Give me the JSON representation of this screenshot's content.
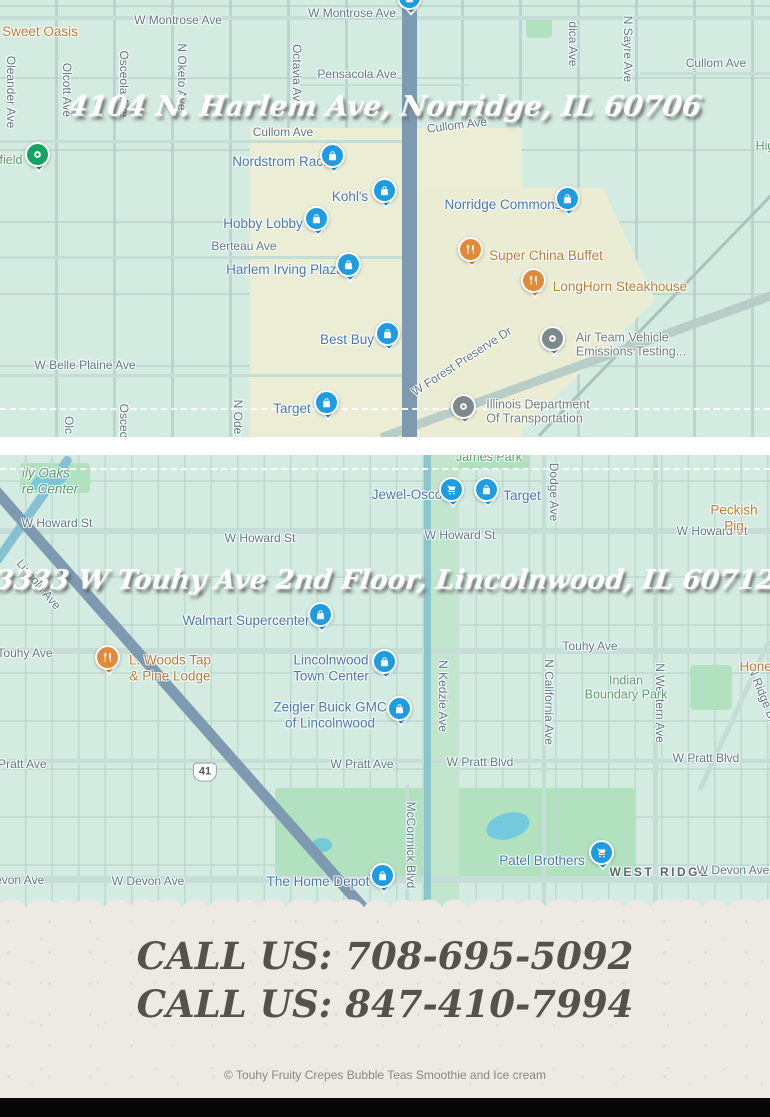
{
  "colors": {
    "pin_blue": "#1d9ce2",
    "pin_orange": "#e18a3a",
    "pin_green": "#15a364",
    "pin_gray": "#7c8a8c",
    "paper": "#eceae3",
    "ink": "#56514b"
  },
  "icons": {
    "shopping": "shopping-bag-pin-icon",
    "grocery": "shopping-cart-pin-icon",
    "restaurant": "restaurant-pin-icon",
    "park": "park-pin-icon",
    "civic": "civic-pin-icon"
  },
  "map1": {
    "title": "4104 N. Harlem Ave, Norridge, IL 60706",
    "labels": [
      {
        "text": "W Montrose Ave",
        "x": 178,
        "y": 21,
        "type": "street"
      },
      {
        "text": "W Montrose Ave",
        "x": 352,
        "y": 14,
        "type": "street"
      },
      {
        "text": "Pensacola Ave",
        "x": 357,
        "y": 75,
        "type": "street"
      },
      {
        "text": "Cullom Ave",
        "x": 283,
        "y": 133,
        "type": "street"
      },
      {
        "text": "Cullom Ave",
        "x": 457,
        "y": 126,
        "type": "street",
        "rot": -7
      },
      {
        "text": "Cullom Ave",
        "x": 716,
        "y": 64,
        "type": "street"
      },
      {
        "text": "Berteau Ave",
        "x": 244,
        "y": 247,
        "type": "street"
      },
      {
        "text": "W Belle Plaine Ave",
        "x": 85,
        "y": 366,
        "type": "street"
      },
      {
        "text": "W Forest Preserve Dr",
        "x": 462,
        "y": 362,
        "type": "street",
        "rot": -33
      },
      {
        "text": "Oleander Ave",
        "x": 10,
        "y": 92,
        "type": "street",
        "vert": true
      },
      {
        "text": "Olcott Ave",
        "x": 66,
        "y": 90,
        "type": "street",
        "vert": true
      },
      {
        "text": "Osceola Ave",
        "x": 123,
        "y": 84,
        "type": "street",
        "vert": true
      },
      {
        "text": "N Oketo Ave",
        "x": 181,
        "y": 77,
        "type": "street",
        "vert": true
      },
      {
        "text": "Octavia Ave",
        "x": 296,
        "y": 76,
        "type": "street",
        "vert": true
      },
      {
        "text": "dica Ave",
        "x": 572,
        "y": 44,
        "type": "street",
        "vert": true
      },
      {
        "text": "N Sayre Ave",
        "x": 627,
        "y": 49,
        "type": "street",
        "vert": true
      },
      {
        "text": "Olc",
        "x": 68,
        "y": 425,
        "type": "street",
        "vert": true
      },
      {
        "text": "Osceo",
        "x": 123,
        "y": 421,
        "type": "street",
        "vert": true
      },
      {
        "text": "N Ode",
        "x": 237,
        "y": 417,
        "type": "street",
        "vert": true
      },
      {
        "text": "Sweet Oasis",
        "x": 40,
        "y": 32,
        "type": "poi-orange"
      },
      {
        "text": "field",
        "x": 11,
        "y": 160,
        "type": "poi-green"
      },
      {
        "text": "Hig",
        "x": 765,
        "y": 146,
        "type": "poi-green"
      },
      {
        "text": "Nordstrom Rack",
        "x": 281,
        "y": 162,
        "type": "poi-blue"
      },
      {
        "text": "Kohl's",
        "x": 350,
        "y": 197,
        "type": "poi-blue"
      },
      {
        "text": "Hobby Lobby",
        "x": 263,
        "y": 224,
        "type": "poi-blue"
      },
      {
        "text": "Harlem Irving Plaza",
        "x": 285,
        "y": 270,
        "type": "poi-blue"
      },
      {
        "text": "Norridge Commons",
        "x": 503,
        "y": 205,
        "type": "poi-blue"
      },
      {
        "text": "Super China Buffet",
        "x": 546,
        "y": 256,
        "type": "poi-orange"
      },
      {
        "text": "LongHorn Steakhouse",
        "x": 620,
        "y": 287,
        "type": "poi-orange"
      },
      {
        "text": "Best Buy",
        "x": 347,
        "y": 340,
        "type": "poi-blue"
      },
      {
        "text": "Target",
        "x": 292,
        "y": 409,
        "type": "poi-blue"
      },
      {
        "text": "Air Team Vehicle\nEmissions Testing...",
        "x": 631,
        "y": 345,
        "type": "poi-gray"
      },
      {
        "text": "Illinois Department\nOf Transportation",
        "x": 538,
        "y": 412,
        "type": "poi-gray"
      }
    ],
    "markers": [
      {
        "kind": "shopping",
        "x": 410,
        "y": 3
      },
      {
        "kind": "shopping",
        "x": 333,
        "y": 161
      },
      {
        "kind": "shopping",
        "x": 385,
        "y": 196
      },
      {
        "kind": "shopping",
        "x": 317,
        "y": 224
      },
      {
        "kind": "shopping",
        "x": 349,
        "y": 270
      },
      {
        "kind": "shopping",
        "x": 568,
        "y": 204
      },
      {
        "kind": "restaurant",
        "x": 471,
        "y": 255
      },
      {
        "kind": "restaurant",
        "x": 534,
        "y": 286
      },
      {
        "kind": "shopping",
        "x": 388,
        "y": 339
      },
      {
        "kind": "shopping",
        "x": 327,
        "y": 408
      },
      {
        "kind": "civic",
        "x": 553,
        "y": 344
      },
      {
        "kind": "civic",
        "x": 464,
        "y": 412
      },
      {
        "kind": "park",
        "x": 38,
        "y": 160
      }
    ]
  },
  "map2": {
    "title": "3333 W Touhy Ave 2nd Floor, Lincolnwood, IL 60712",
    "labels": [
      {
        "text": "James Park",
        "x": 489,
        "y": 2,
        "type": "poi-green"
      },
      {
        "text": "ily Oaks\nre Center",
        "x": 50,
        "y": 26,
        "type": "poi-green-italic"
      },
      {
        "text": "W Howard St",
        "x": 57,
        "y": 69,
        "type": "street"
      },
      {
        "text": "W Howard St",
        "x": 260,
        "y": 84,
        "type": "street"
      },
      {
        "text": "W Howard St",
        "x": 460,
        "y": 81,
        "type": "street"
      },
      {
        "text": "W Howard St",
        "x": 712,
        "y": 77,
        "type": "street"
      },
      {
        "text": "Peckish Pig",
        "x": 734,
        "y": 63,
        "type": "poi-orange"
      },
      {
        "text": "Lincoln Ave",
        "x": 38,
        "y": 130,
        "type": "street",
        "rot": 50
      },
      {
        "text": "Dodge Ave",
        "x": 553,
        "y": 37,
        "type": "street",
        "vert": true
      },
      {
        "text": "Touhy Ave",
        "x": 25,
        "y": 199,
        "type": "street"
      },
      {
        "text": "Touhy Ave",
        "x": 590,
        "y": 192,
        "type": "street"
      },
      {
        "text": "N Kedzie Ave",
        "x": 442,
        "y": 241,
        "type": "street",
        "vert": true
      },
      {
        "text": "N California Ave",
        "x": 548,
        "y": 247,
        "type": "street",
        "vert": true
      },
      {
        "text": "N Western Ave",
        "x": 659,
        "y": 248,
        "type": "street",
        "vert": true
      },
      {
        "text": "N Ridge Blvd",
        "x": 764,
        "y": 245,
        "type": "street",
        "rot": 68
      },
      {
        "text": "Indian\nBoundary Park",
        "x": 626,
        "y": 233,
        "type": "poi-green"
      },
      {
        "text": "Honey",
        "x": 759,
        "y": 212,
        "type": "poi-orange"
      },
      {
        "text": "W Pratt Ave",
        "x": 15,
        "y": 310,
        "type": "street"
      },
      {
        "text": "W Pratt Ave",
        "x": 362,
        "y": 310,
        "type": "street"
      },
      {
        "text": "41",
        "x": 205,
        "y": 317,
        "type": "shield"
      },
      {
        "text": "W Pratt Blvd",
        "x": 480,
        "y": 308,
        "type": "street"
      },
      {
        "text": "W Pratt Blvd",
        "x": 706,
        "y": 304,
        "type": "street"
      },
      {
        "text": "McCormick Blvd",
        "x": 410,
        "y": 390,
        "type": "street",
        "vert": true
      },
      {
        "text": "W Devon Ave",
        "x": 8,
        "y": 426,
        "type": "street"
      },
      {
        "text": "W Devon Ave",
        "x": 148,
        "y": 427,
        "type": "street"
      },
      {
        "text": "WEST RIDGE",
        "x": 660,
        "y": 418,
        "type": "poi-dark"
      },
      {
        "text": "W Devon Ave",
        "x": 733,
        "y": 416,
        "type": "street"
      },
      {
        "text": "Jewel-Osco",
        "x": 407,
        "y": 40,
        "type": "poi-blue"
      },
      {
        "text": "Target",
        "x": 522,
        "y": 41,
        "type": "poi-blue"
      },
      {
        "text": "Walmart Supercenter",
        "x": 246,
        "y": 166,
        "type": "poi-blue"
      },
      {
        "text": "L. Woods Tap\n& Pine Lodge",
        "x": 170,
        "y": 213,
        "type": "poi-orange"
      },
      {
        "text": "Lincolnwood\nTown Center",
        "x": 331,
        "y": 213,
        "type": "poi-blue"
      },
      {
        "text": "Zeigler Buick GMC\nof Lincolnwood",
        "x": 330,
        "y": 260,
        "type": "poi-blue"
      },
      {
        "text": "The Home Depot",
        "x": 318,
        "y": 427,
        "type": "poi-blue"
      },
      {
        "text": "Patel Brothers",
        "x": 542,
        "y": 406,
        "type": "poi-blue"
      }
    ],
    "markers": [
      {
        "kind": "grocery",
        "x": 452,
        "y": 40
      },
      {
        "kind": "shopping",
        "x": 487,
        "y": 40
      },
      {
        "kind": "shopping",
        "x": 321,
        "y": 165
      },
      {
        "kind": "restaurant",
        "x": 108,
        "y": 208
      },
      {
        "kind": "shopping",
        "x": 385,
        "y": 212
      },
      {
        "kind": "shopping",
        "x": 400,
        "y": 259
      },
      {
        "kind": "shopping",
        "x": 383,
        "y": 426
      },
      {
        "kind": "grocery",
        "x": 602,
        "y": 403
      }
    ]
  },
  "footer": {
    "phone1": "CALL US: 708-695-5092",
    "phone2": "CALL US: 847-410-7994",
    "copyright": "© Touhy Fruity Crepes Bubble Teas Smoothie and Ice cream"
  }
}
